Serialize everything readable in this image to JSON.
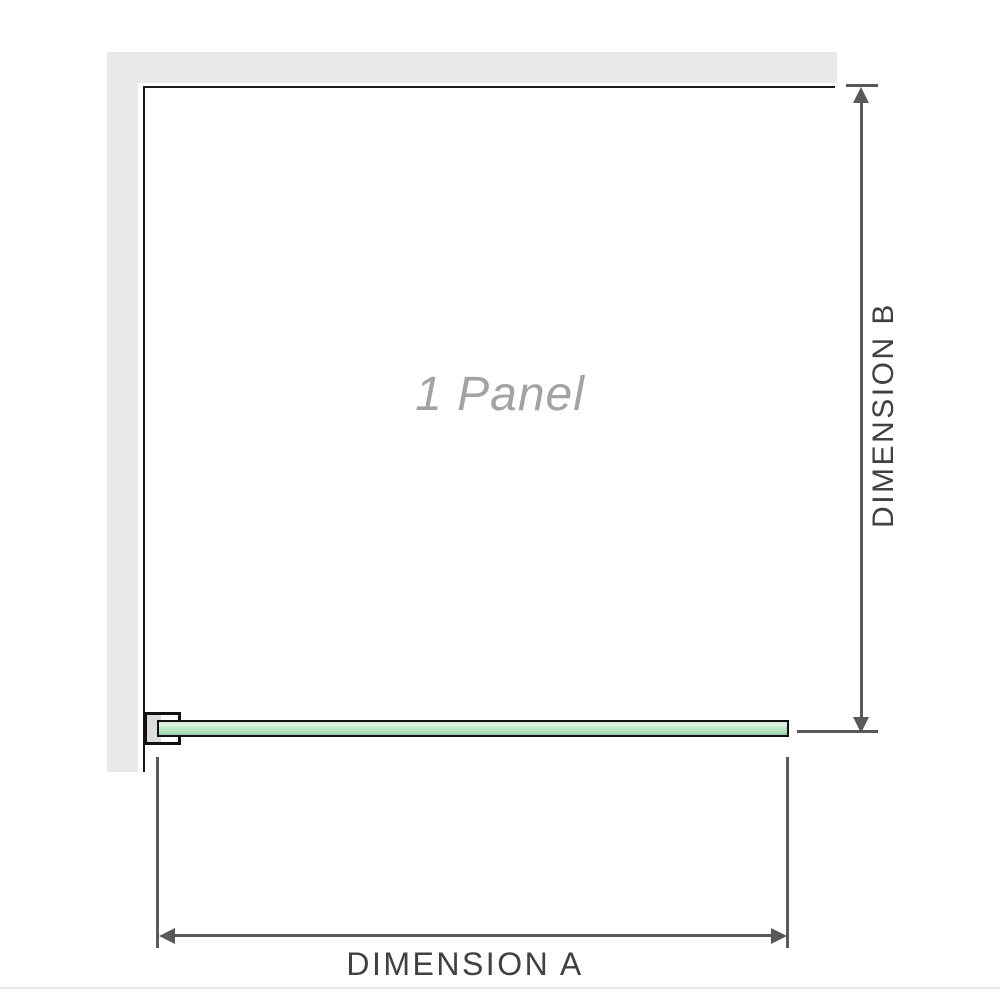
{
  "diagram": {
    "panel_label": "1 Panel",
    "dimension_a_label": "DIMENSION A",
    "dimension_b_label": "DIMENSION B"
  },
  "colors": {
    "wall": "#e9e9e9",
    "panel_border": "#1a1a1a",
    "glass_fill": "#b9e4c4",
    "glass_highlight": "#e2f3e5",
    "glass_border": "#111111",
    "bracket_pad": "#dcdcdc",
    "dimension_line": "#58595b",
    "dimension_text": "#414042",
    "panel_label_text": "#a3a3a3",
    "bottom_divider": "#e8e8e8"
  }
}
